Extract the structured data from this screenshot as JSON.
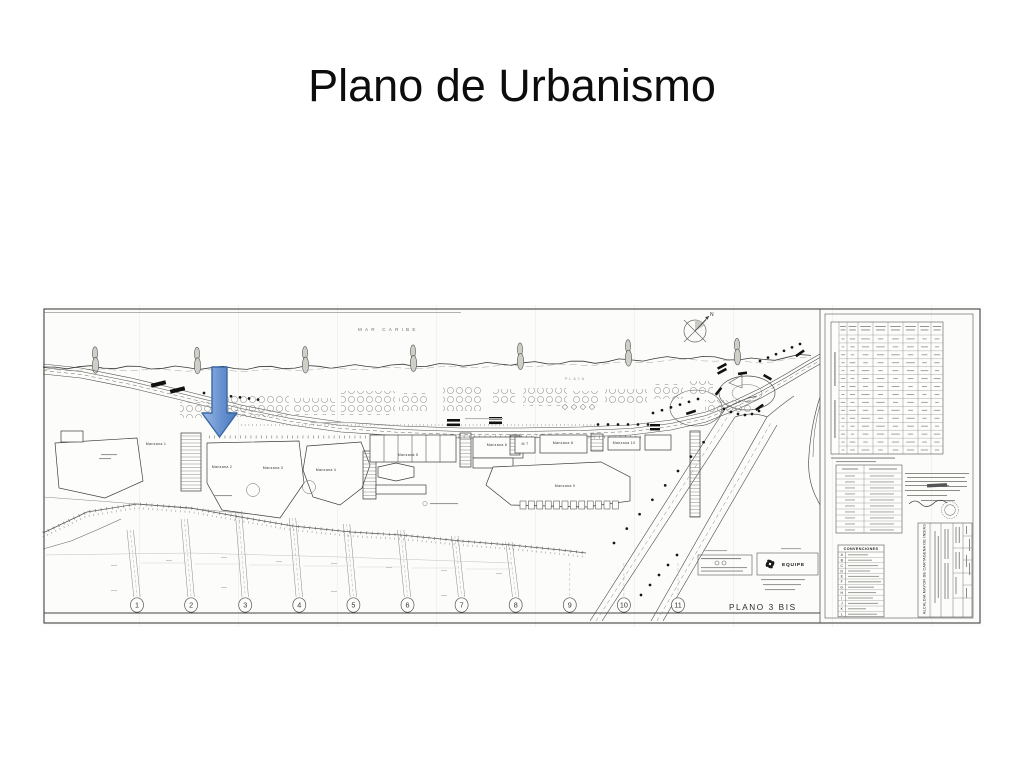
{
  "slide": {
    "title": "Plano de Urbanismo"
  },
  "sheet": {
    "sea_label": "MAR CARIBE",
    "beach_label": "PLAYA",
    "plan_label": "PLANO 3 BIS",
    "north_label": "N",
    "equipe_label": "EQUIPE",
    "legend_title": "CONVENCIONES",
    "legend_rows": [
      "A",
      "B",
      "C",
      "D",
      "E",
      "F",
      "G",
      "H",
      "I",
      "J",
      "K",
      "L"
    ],
    "blocks": [
      {
        "label": "Manzana 1",
        "x": 115,
        "y": 140
      },
      {
        "label": "Manzana 2",
        "x": 181,
        "y": 163
      },
      {
        "label": "Manzana 3",
        "x": 232,
        "y": 164
      },
      {
        "label": "Manzana 4",
        "x": 285,
        "y": 166
      },
      {
        "label": "Manzana 5",
        "x": 367,
        "y": 151
      },
      {
        "label": "Manzana 6",
        "x": 456,
        "y": 141
      },
      {
        "label": "M 7",
        "x": 484,
        "y": 140
      },
      {
        "label": "Manzana 8",
        "x": 522,
        "y": 139
      },
      {
        "label": "Manzana 9",
        "x": 524,
        "y": 182
      },
      {
        "label": "Manzana 10",
        "x": 583,
        "y": 139
      }
    ],
    "section_numbers": [
      "1",
      "2",
      "3",
      "4",
      "5",
      "6",
      "7",
      "8",
      "9",
      "10",
      "11"
    ],
    "title_block_label": "ALCALDIA MAYOR DE CARTAGENA DE INDIAS",
    "annotation_arrow": {
      "fill_light": "#9cbbe5",
      "fill_mid": "#6791cf",
      "fill_dark": "#4a7abf",
      "stroke": "#3a67a6"
    }
  }
}
